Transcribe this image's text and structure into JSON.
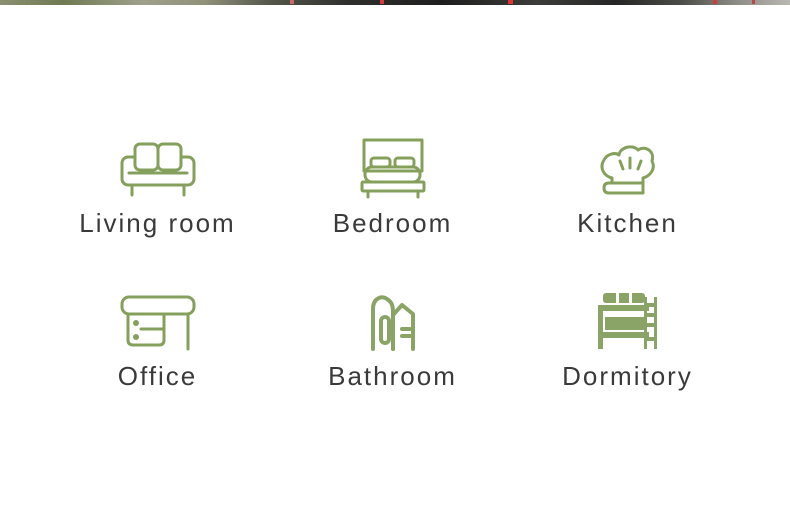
{
  "page": {
    "background": "#ffffff",
    "top_strip": {
      "description": "cut-off photo edge",
      "colors": [
        "#7a8464",
        "#9c9d8a",
        "#3a3a38",
        "#1f1f1f",
        "#8b8b84"
      ],
      "speck_color": "#d23b3b"
    }
  },
  "theme": {
    "icon_green": "#85a05c",
    "icon_green_deep": "#8aa468",
    "label_color": "#3a3a3a"
  },
  "categories": [
    {
      "label": "Living room",
      "icon": "sofa-icon"
    },
    {
      "label": "Bedroom",
      "icon": "bed-icon"
    },
    {
      "label": "Kitchen",
      "icon": "chef-hat-icon"
    },
    {
      "label": "Office",
      "icon": "desk-icon"
    },
    {
      "label": "Bathroom",
      "icon": "buildings-icon"
    },
    {
      "label": "Dormitory",
      "icon": "bunk-bed-icon"
    }
  ]
}
